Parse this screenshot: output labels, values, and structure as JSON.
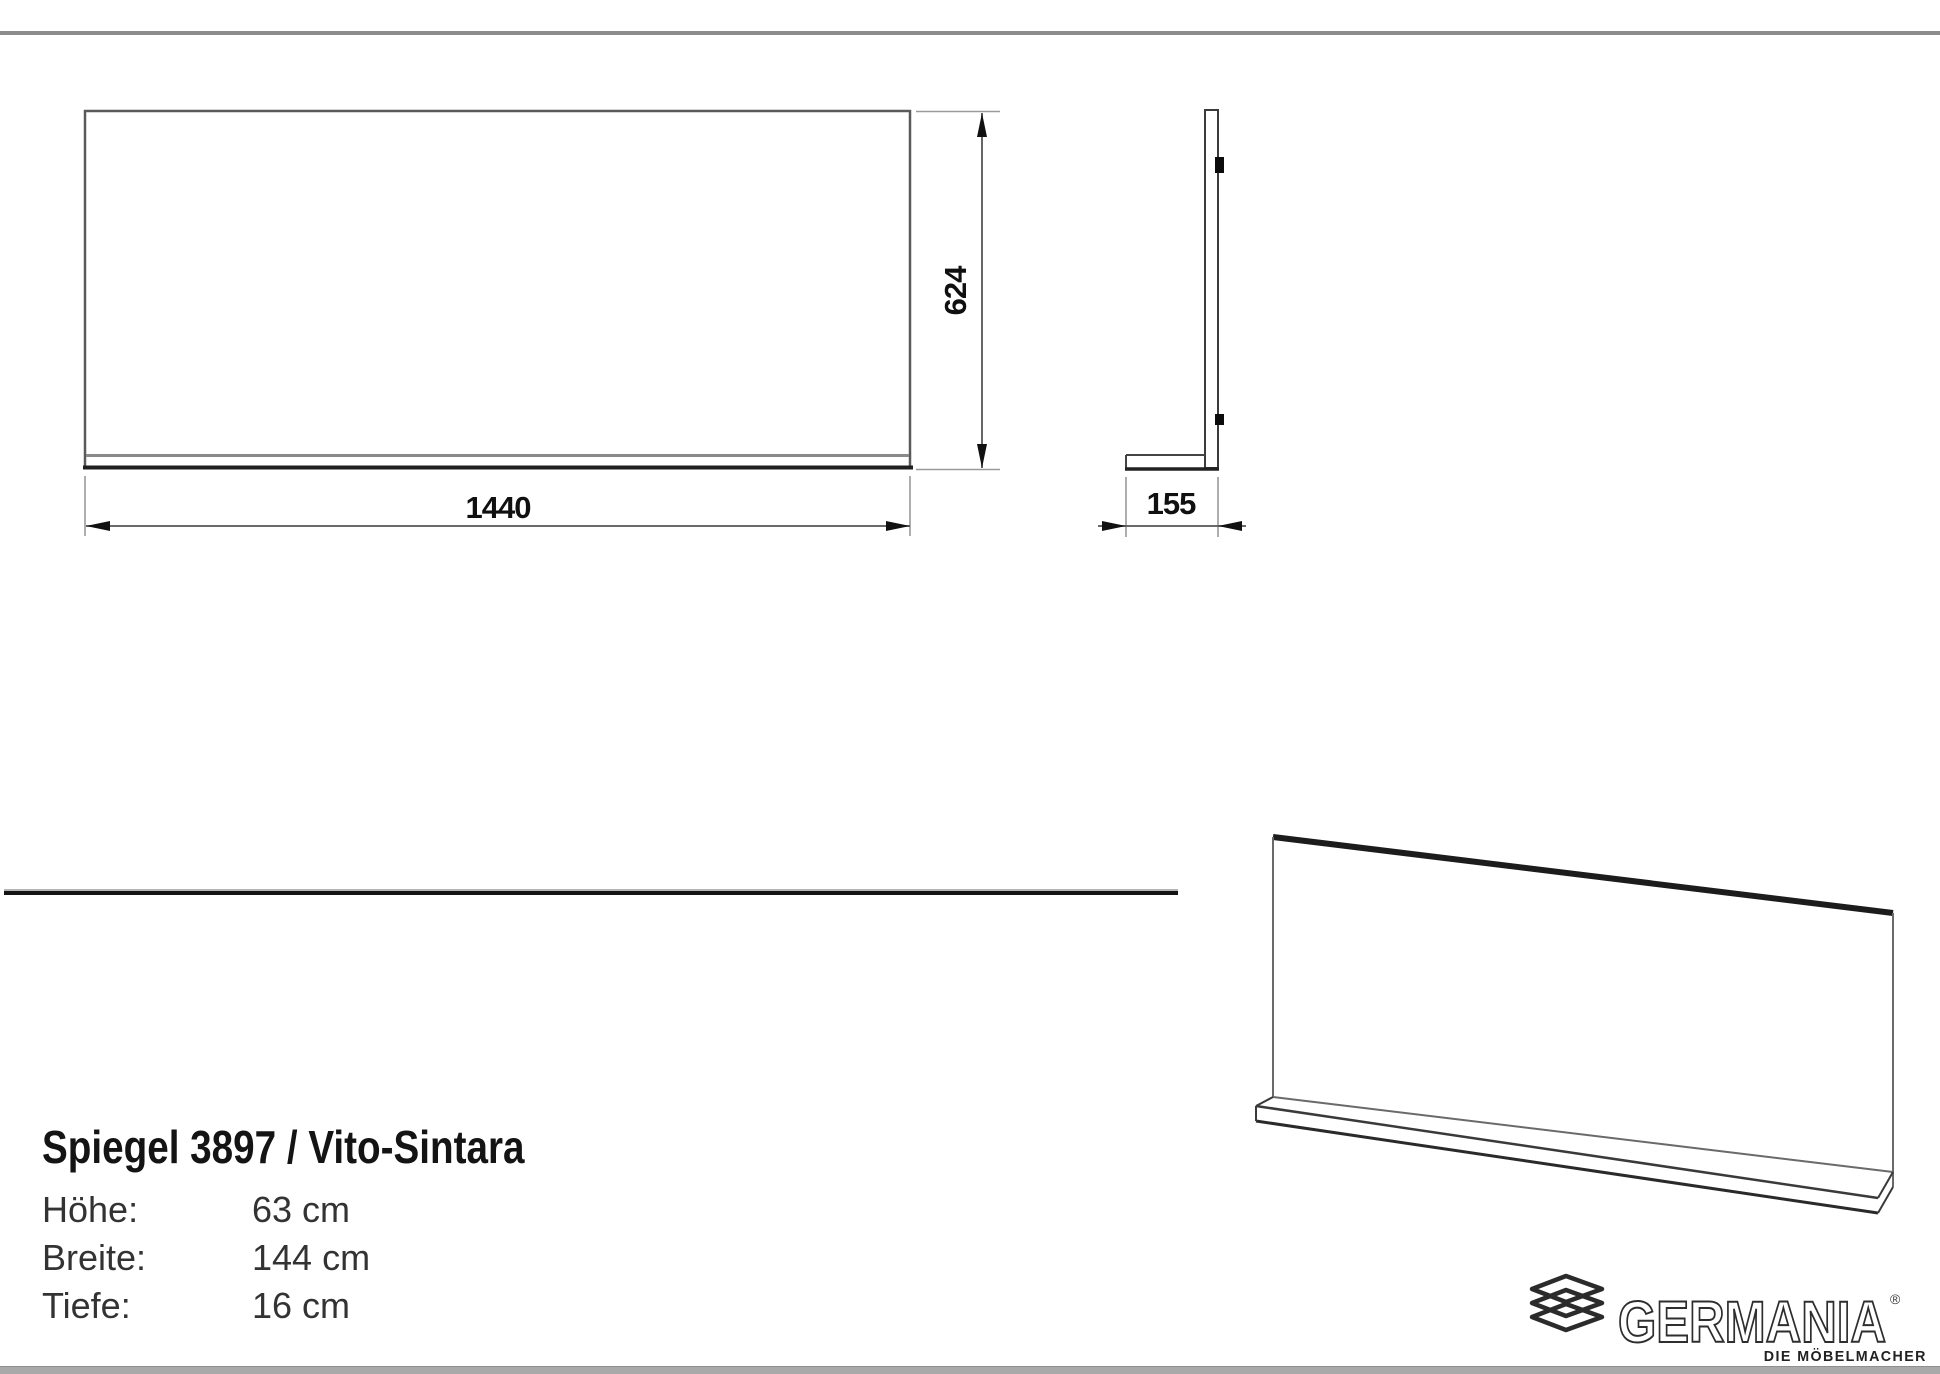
{
  "document": {
    "type": "furniture-dimension-sheet",
    "colors": {
      "outline_gray": "#5a5a5a",
      "dim_line": "#555555",
      "extension_line": "#9a9a9a",
      "heavy_line": "#1c1c1c",
      "top_rule": "#8c8c8c",
      "bottom_bar": "#a9a9a9",
      "divider": "#141414"
    }
  },
  "dimensions": {
    "front_width_label": "1440",
    "front_height_label": "624",
    "side_depth_label": "155"
  },
  "product": {
    "title": "Spiegel 3897 / Vito-Sintara",
    "specs": [
      {
        "label": "Höhe:",
        "value": "63 cm"
      },
      {
        "label": "Breite:",
        "value": "144 cm"
      },
      {
        "label": "Tiefe:",
        "value": "16 cm"
      }
    ]
  },
  "brand": {
    "name": "GERMANIA",
    "registered_mark": "®",
    "tagline": "DIE MÖBELMACHER",
    "icon": "stacked-boards-icon"
  }
}
